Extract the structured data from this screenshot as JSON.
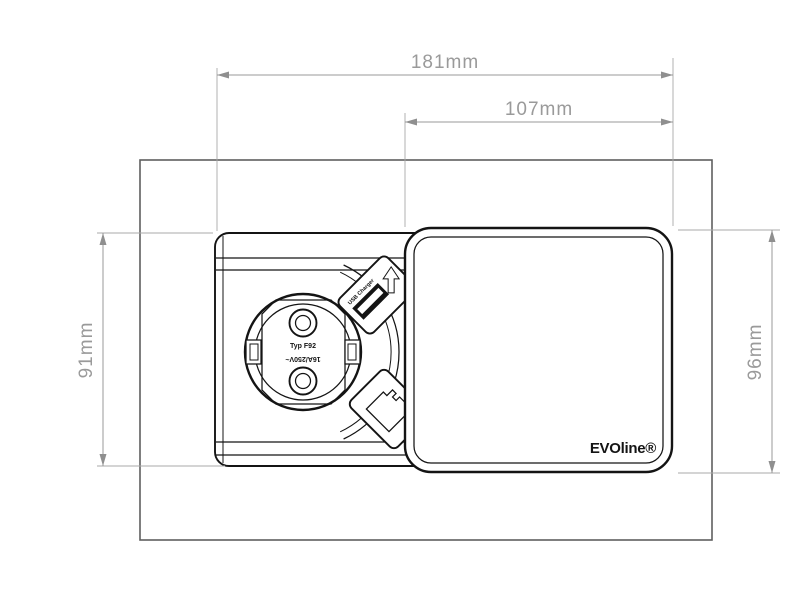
{
  "drawing": {
    "title": "EVOline socket unit dimension drawing",
    "dimensions": {
      "width_total": "181mm",
      "width_lid": "107mm",
      "height_unit": "91mm",
      "height_lid": "96mm"
    },
    "socket": {
      "type_label": "Typ F92",
      "rating_label": "16A/250V~",
      "usb_label": "USB Charger"
    },
    "lid": {
      "brand": "EVOline®"
    },
    "icons": {
      "schuko_socket": "schuko-socket-icon",
      "usb_port": "usb-port-icon",
      "charging_arrow": "charging-arrow-icon",
      "rj45_jack": "rj45-jack-icon"
    },
    "colors": {
      "drawing_line": "#141414",
      "dimension_line": "#9a9a9a",
      "mounting_outline": "#5f5f5f",
      "background": "#ffffff"
    }
  }
}
